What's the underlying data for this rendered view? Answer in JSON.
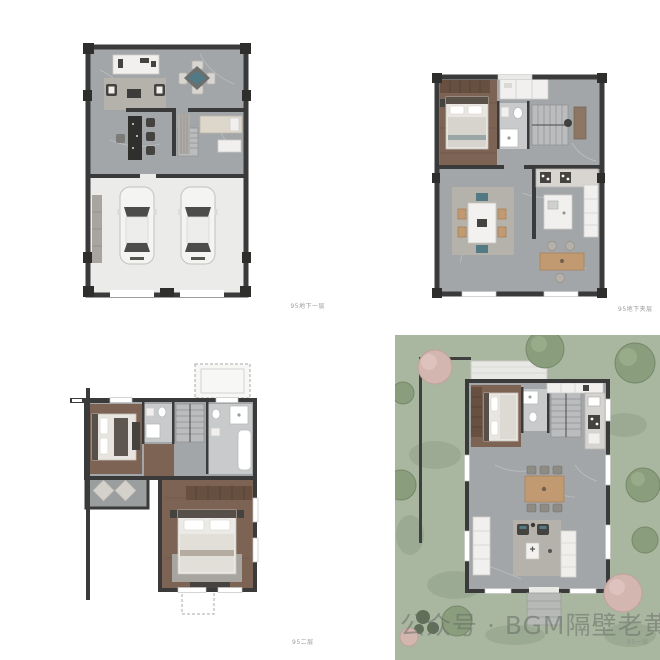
{
  "watermark": {
    "text": "公众号 · BGM隔壁老黄"
  },
  "plans": [
    {
      "id": "basement-level-1",
      "label": "95地下一层",
      "position": "top-left",
      "elements": [
        "tv-console-icon",
        "sofa-rug-icon",
        "armchair-icon",
        "game-table-icon",
        "bar-counter-icon",
        "bar-stool-icon",
        "stairs-icon",
        "closet-icon",
        "daybed-icon",
        "garage-icon",
        "car-icon"
      ],
      "features": {
        "car_count": 2
      }
    },
    {
      "id": "basement-mezzanine",
      "label": "95地下夹层",
      "position": "top-right",
      "elements": [
        "wardrobe-icon",
        "bed-icon",
        "closet-icon",
        "bathroom-icon",
        "stairs-icon",
        "desk-icon",
        "dining-table-icon",
        "kitchen-counter-icon",
        "island-icon",
        "bar-table-icon",
        "stool-icon"
      ]
    },
    {
      "id": "second-floor",
      "label": "95二层",
      "position": "bottom-left",
      "elements": [
        "bed-icon",
        "bathroom-icon",
        "stairs-icon",
        "bathtub-icon",
        "shower-icon",
        "balcony-icon",
        "lounge-chair-icon",
        "wardrobe-icon",
        "master-bed-icon",
        "dashed-roof-outline"
      ]
    },
    {
      "id": "first-floor",
      "label": "95一层",
      "position": "bottom-right",
      "elements": [
        "garden-lawn",
        "tree-icon",
        "bush-icon",
        "fence-icon",
        "terrace-icon",
        "wardrobe-icon",
        "bed-icon",
        "bathroom-icon",
        "stairs-icon",
        "kitchen-counter-icon",
        "dining-table-icon",
        "armchair-icon",
        "coffee-table-icon",
        "sofa-icon",
        "cabinet-icon",
        "entry-path-icon"
      ]
    }
  ],
  "colors": {
    "background": "#ffffff",
    "wall": "#3a3a3a",
    "marble_floor": "#a3a6a9",
    "garage_floor": "#ebebe9",
    "wood_floor": "#7c6354",
    "wood_furniture": "#c19a72",
    "lawn": "#a9b7a0",
    "tree_green": "#8a9d7c",
    "tree_pink": "#d3b6b0",
    "teal_accent": "#527a84",
    "rug_grey": "#b5b2ac",
    "white_fixture": "#f1f0ee"
  }
}
